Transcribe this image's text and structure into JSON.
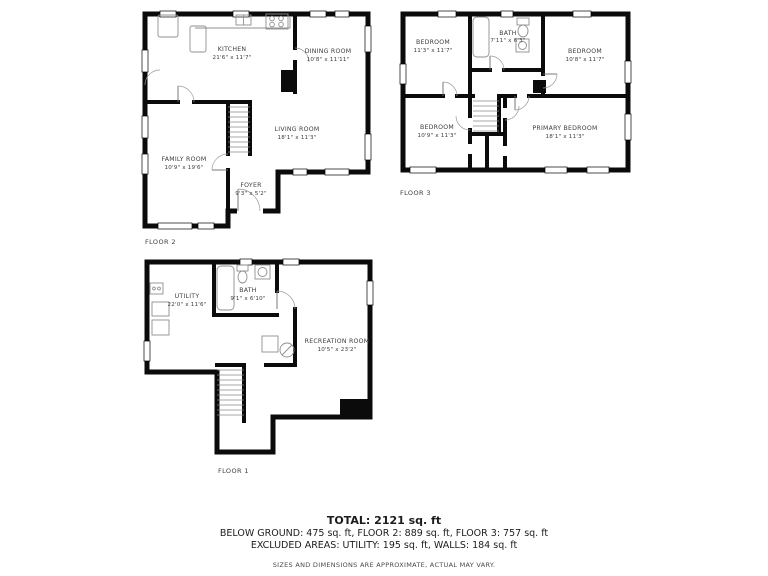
{
  "floors": [
    {
      "label": "FLOOR 2",
      "rooms": [
        {
          "name": "KITCHEN",
          "dims": "21'6\" x 11'7\""
        },
        {
          "name": "DINING ROOM",
          "dims": "10'8\" x 11'11\""
        },
        {
          "name": "LIVING ROOM",
          "dims": "18'1\" x 11'3\""
        },
        {
          "name": "FAMILY ROOM",
          "dims": "10'9\" x 19'6\""
        },
        {
          "name": "FOYER",
          "dims": "9'3\" x 5'2\""
        }
      ]
    },
    {
      "label": "FLOOR 3",
      "rooms": [
        {
          "name": "BEDROOM",
          "dims": "11'3\" x 11'7\""
        },
        {
          "name": "BATH",
          "dims": "7'11\" x 6'3\""
        },
        {
          "name": "BEDROOM",
          "dims": "10'8\" x 11'7\""
        },
        {
          "name": "BEDROOM",
          "dims": "10'9\" x 11'3\""
        },
        {
          "name": "PRIMARY BEDROOM",
          "dims": "18'1\" x 11'3\""
        }
      ]
    },
    {
      "label": "FLOOR 1",
      "rooms": [
        {
          "name": "UTILITY",
          "dims": "22'0\" x 11'6\""
        },
        {
          "name": "BATH",
          "dims": "9'1\" x 6'10\""
        },
        {
          "name": "RECREATION ROOM",
          "dims": "10'5\" x 23'2\""
        }
      ]
    }
  ],
  "summary": {
    "total": "TOTAL: 2121 sq. ft",
    "line2": "BELOW GROUND: 475 sq. ft, FLOOR 2: 889 sq. ft, FLOOR 3: 757 sq. ft",
    "line3": "EXCLUDED AREAS: UTILITY: 195 sq. ft, WALLS: 184 sq. ft",
    "disclaimer": "SIZES AND DIMENSIONS ARE APPROXIMATE, ACTUAL MAY VARY."
  },
  "colors": {
    "wall": "#0b0b0b",
    "furniture": "#8f8f8f",
    "text": "#3c3c3c"
  }
}
